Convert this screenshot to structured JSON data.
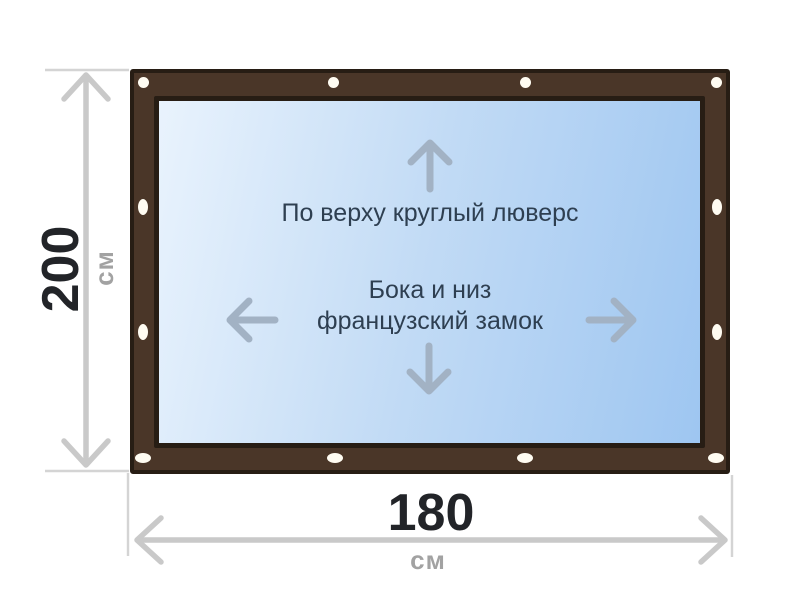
{
  "diagram": {
    "annotation_top": "По верху круглый люверс",
    "annotation_middle_line1": "Бока и низ",
    "annotation_middle_line2": "французский замок",
    "grommet_count": 12
  },
  "dimensions": {
    "height_value": "200",
    "height_unit": "см",
    "width_value": "180",
    "width_unit": "см"
  },
  "icons": {
    "arrow_up": "↑",
    "arrow_down": "↓",
    "arrow_left": "←",
    "arrow_right": "→",
    "grommet": "●"
  },
  "colors": {
    "frame_brown": "#4a3628",
    "frame_outline": "#271d14",
    "panel_light": "#e9f3fd",
    "panel_mid": "#c2dbf5",
    "panel_deep": "#9ec6f1",
    "arrow_blue_gray": "#a2b2c4",
    "dim_line_gray": "#c9c9c9",
    "tick_gray": "#d4d4d4",
    "annotation_text": "#2e3f51",
    "dim_value_text": "#222428",
    "dim_unit_text": "#a2a2a2",
    "grommet_white": "#fffcf2"
  }
}
